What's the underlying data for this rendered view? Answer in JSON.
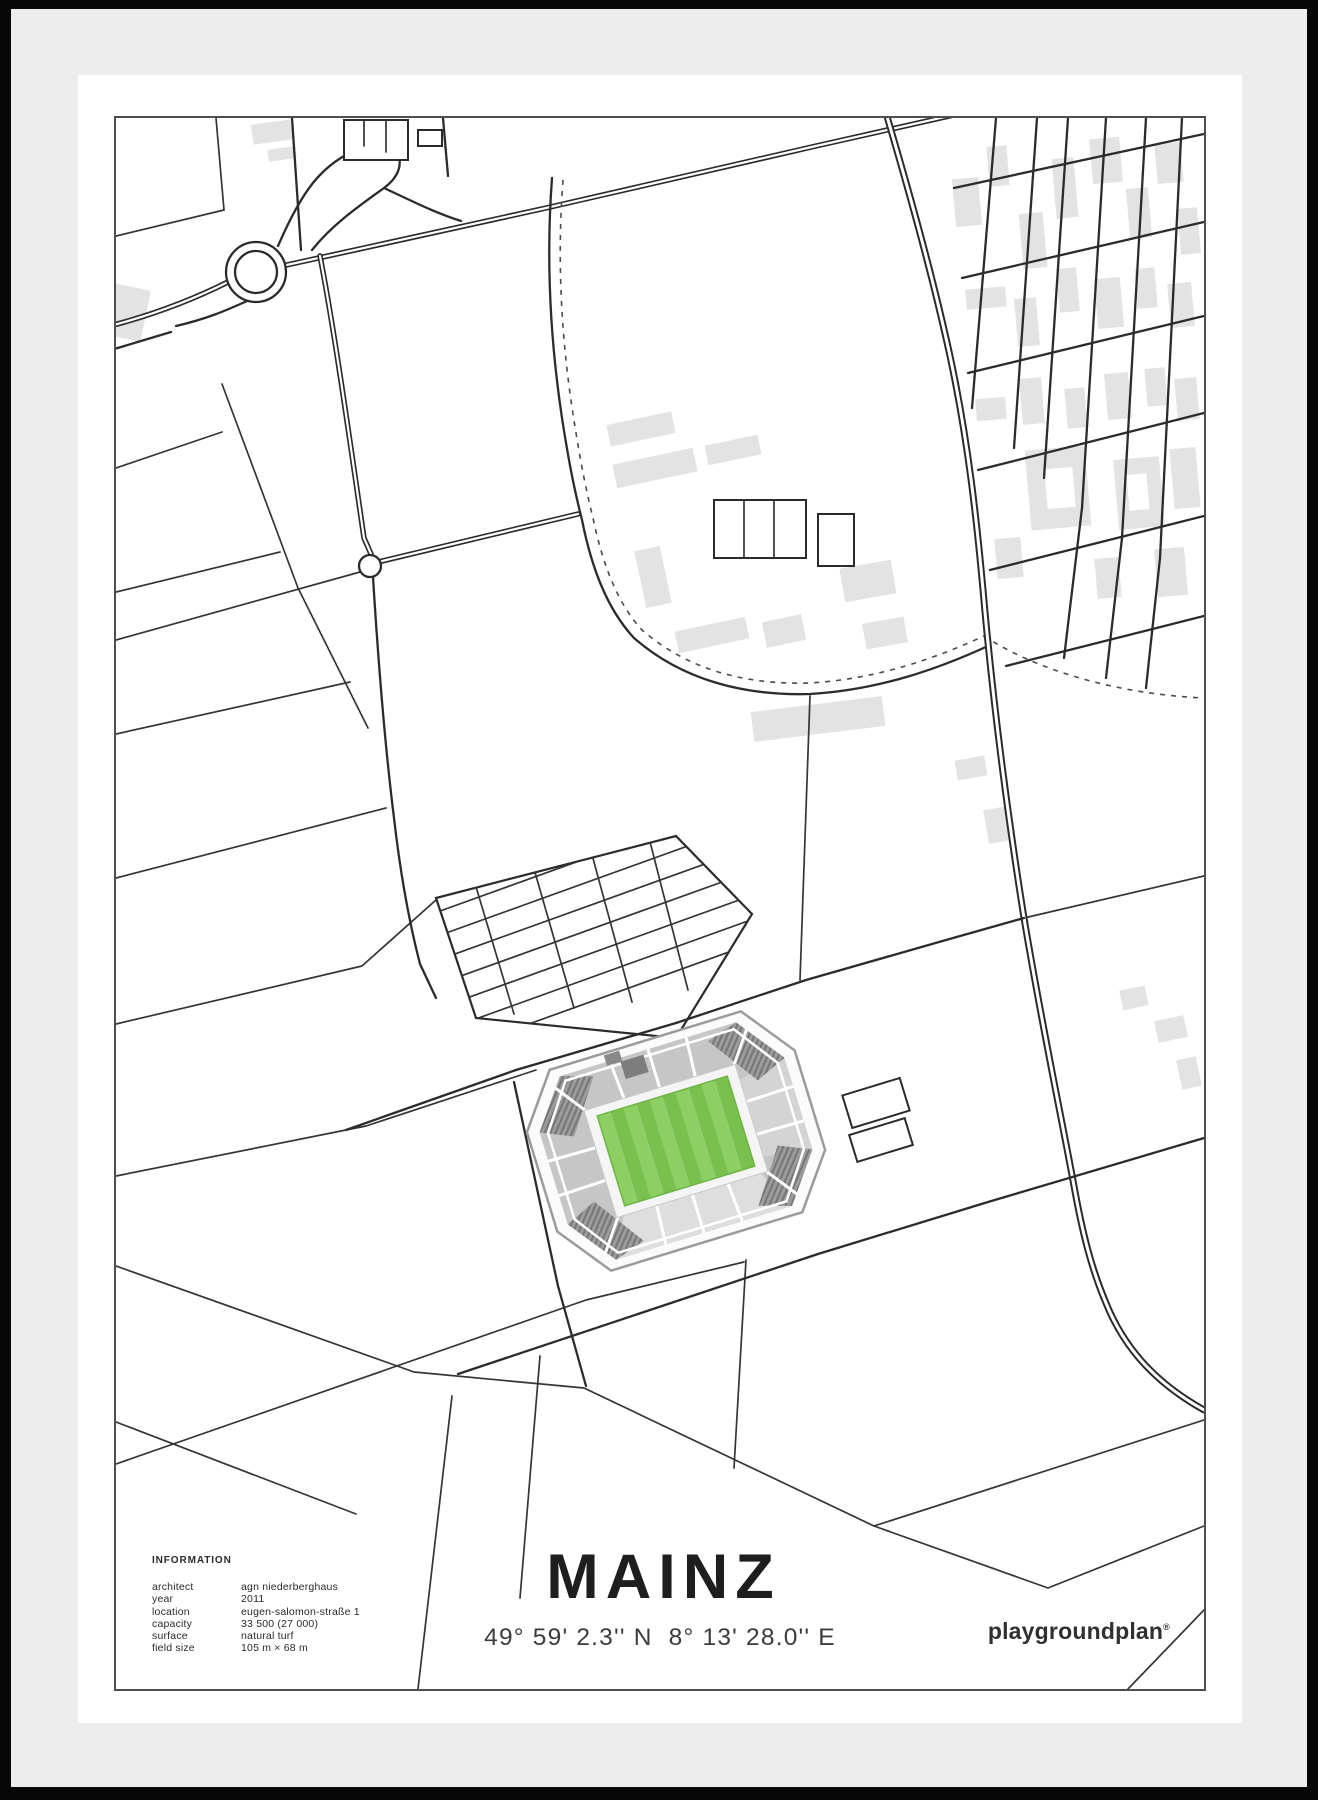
{
  "poster": {
    "title": "MAINZ",
    "coordinates": "49° 59' 2.3'' N  8° 13' 28.0'' E",
    "brand": {
      "name": "playgroundplan",
      "registered_mark": "®"
    },
    "information": {
      "heading": "INFORMATION",
      "rows": [
        {
          "label": "architect",
          "value": "agn niederberghaus"
        },
        {
          "label": "year",
          "value": "2011"
        },
        {
          "label": "location",
          "value": "eugen-salomon-straße 1"
        },
        {
          "label": "capacity",
          "value": "33 500 (27 000)"
        },
        {
          "label": "surface",
          "value": "natural turf"
        },
        {
          "label": "field size",
          "value": "105 m × 68 m"
        }
      ]
    },
    "map": {
      "colors": {
        "frame_black": "#060606",
        "frame_gray": "#ededed",
        "mat_white": "#ffffff",
        "map_border": "#4f4f4f",
        "road": "#2b2b2b",
        "building": "#e3e3e3",
        "stand_light": "#c6c6c6",
        "stand_dark": "#8d8d8d",
        "pitch_green_light": "#8ccf63",
        "pitch_green_dark": "#7ac04e"
      },
      "features": [
        "roundabout-interchange",
        "motorway",
        "street-grid",
        "university-campus",
        "tram-dashed-line",
        "field-parcels",
        "parking-grid",
        "stadium-footprint"
      ]
    }
  }
}
